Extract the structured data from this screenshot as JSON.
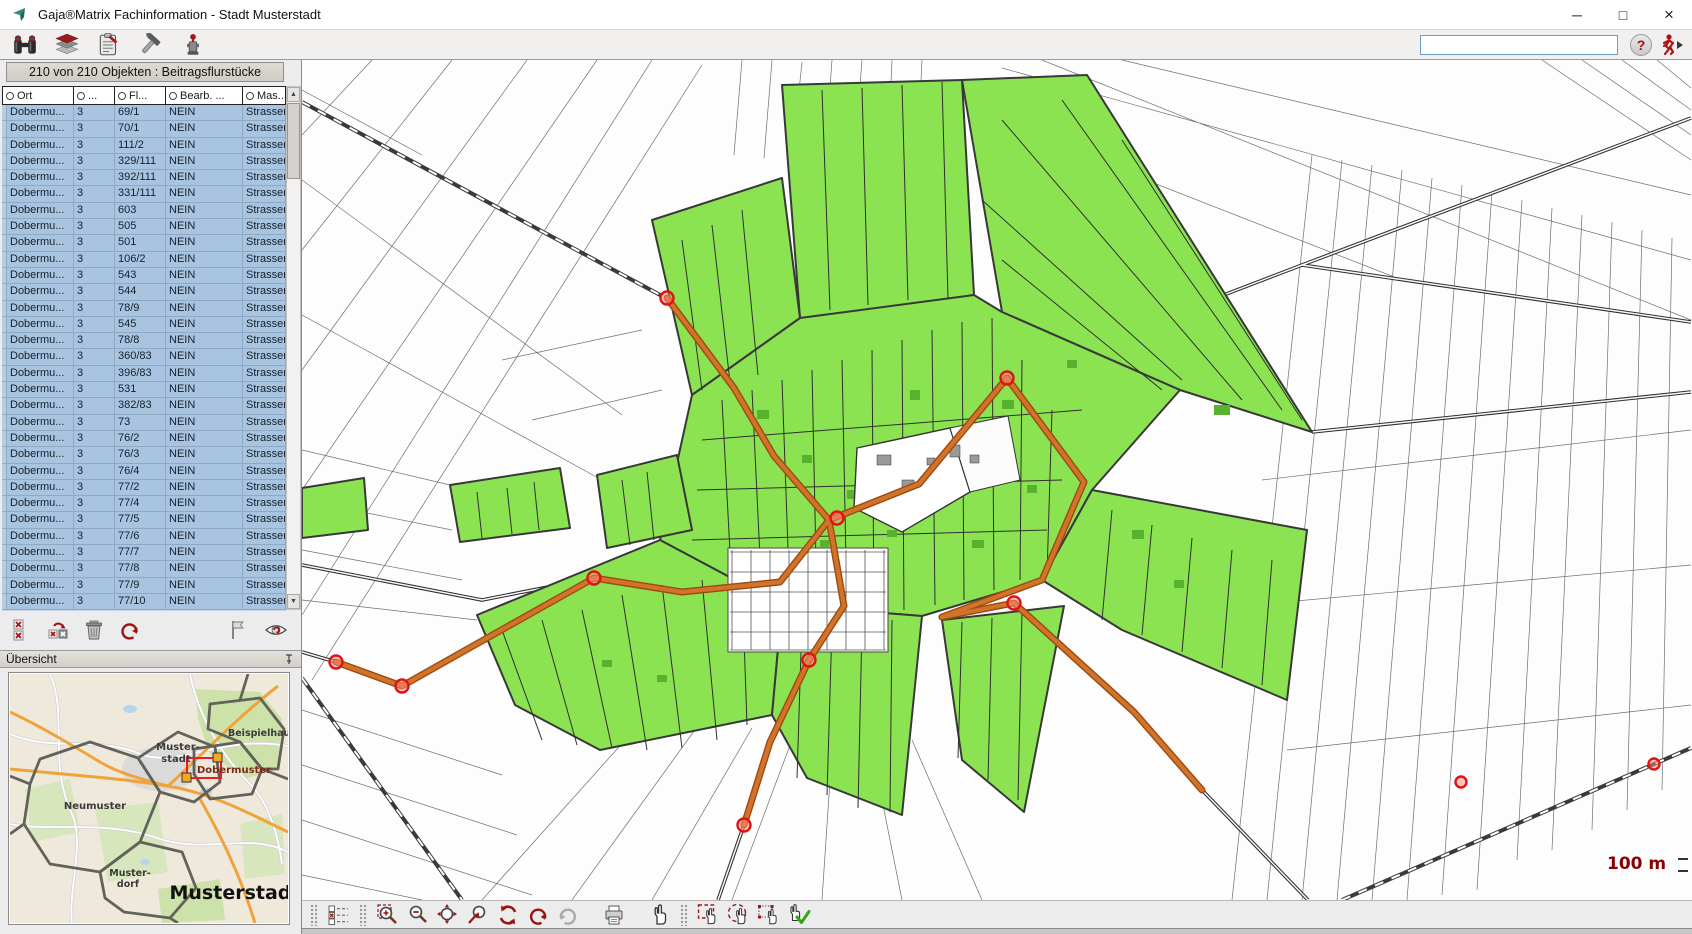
{
  "window": {
    "title": "Gaja®Matrix Fachinformation - Stadt Musterstadt",
    "minimize": "─",
    "maximize": "□",
    "close": "×"
  },
  "toolbar": {
    "icons": [
      "find",
      "layers",
      "report",
      "tools",
      "hydrant"
    ],
    "search_value": "",
    "help_label": "?",
    "exit_icon": "exit-run"
  },
  "results_panel": {
    "header": "210 von 210 Objekten : Beitragsflurstücke",
    "columns": [
      "Ort",
      "...",
      "Fl...",
      "Bearb. ...",
      "Mas..."
    ],
    "rows": [
      {
        "ort": "Dobermu...",
        "nr": "3",
        "fl": "69/1",
        "bearb": "NEIN",
        "mas": "Strassen..."
      },
      {
        "ort": "Dobermu...",
        "nr": "3",
        "fl": "70/1",
        "bearb": "NEIN",
        "mas": "Strassen..."
      },
      {
        "ort": "Dobermu...",
        "nr": "3",
        "fl": "111/2",
        "bearb": "NEIN",
        "mas": "Strassen..."
      },
      {
        "ort": "Dobermu...",
        "nr": "3",
        "fl": "329/111",
        "bearb": "NEIN",
        "mas": "Strassen..."
      },
      {
        "ort": "Dobermu...",
        "nr": "3",
        "fl": "392/111",
        "bearb": "NEIN",
        "mas": "Strassen..."
      },
      {
        "ort": "Dobermu...",
        "nr": "3",
        "fl": "331/111",
        "bearb": "NEIN",
        "mas": "Strassen..."
      },
      {
        "ort": "Dobermu...",
        "nr": "3",
        "fl": "603",
        "bearb": "NEIN",
        "mas": "Strassen..."
      },
      {
        "ort": "Dobermu...",
        "nr": "3",
        "fl": "505",
        "bearb": "NEIN",
        "mas": "Strassen..."
      },
      {
        "ort": "Dobermu...",
        "nr": "3",
        "fl": "501",
        "bearb": "NEIN",
        "mas": "Strassen..."
      },
      {
        "ort": "Dobermu...",
        "nr": "3",
        "fl": "106/2",
        "bearb": "NEIN",
        "mas": "Strassen..."
      },
      {
        "ort": "Dobermu...",
        "nr": "3",
        "fl": "543",
        "bearb": "NEIN",
        "mas": "Strassen..."
      },
      {
        "ort": "Dobermu...",
        "nr": "3",
        "fl": "544",
        "bearb": "NEIN",
        "mas": "Strassen..."
      },
      {
        "ort": "Dobermu...",
        "nr": "3",
        "fl": "78/9",
        "bearb": "NEIN",
        "mas": "Strassen..."
      },
      {
        "ort": "Dobermu...",
        "nr": "3",
        "fl": "545",
        "bearb": "NEIN",
        "mas": "Strassen..."
      },
      {
        "ort": "Dobermu...",
        "nr": "3",
        "fl": "78/8",
        "bearb": "NEIN",
        "mas": "Strassen..."
      },
      {
        "ort": "Dobermu...",
        "nr": "3",
        "fl": "360/83",
        "bearb": "NEIN",
        "mas": "Strassen..."
      },
      {
        "ort": "Dobermu...",
        "nr": "3",
        "fl": "396/83",
        "bearb": "NEIN",
        "mas": "Strassen..."
      },
      {
        "ort": "Dobermu...",
        "nr": "3",
        "fl": "531",
        "bearb": "NEIN",
        "mas": "Strassen..."
      },
      {
        "ort": "Dobermu...",
        "nr": "3",
        "fl": "382/83",
        "bearb": "NEIN",
        "mas": "Strassen..."
      },
      {
        "ort": "Dobermu...",
        "nr": "3",
        "fl": "73",
        "bearb": "NEIN",
        "mas": "Strassen..."
      },
      {
        "ort": "Dobermu...",
        "nr": "3",
        "fl": "76/2",
        "bearb": "NEIN",
        "mas": "Strassen..."
      },
      {
        "ort": "Dobermu...",
        "nr": "3",
        "fl": "76/3",
        "bearb": "NEIN",
        "mas": "Strassen..."
      },
      {
        "ort": "Dobermu...",
        "nr": "3",
        "fl": "76/4",
        "bearb": "NEIN",
        "mas": "Strassen..."
      },
      {
        "ort": "Dobermu...",
        "nr": "3",
        "fl": "77/2",
        "bearb": "NEIN",
        "mas": "Strassen..."
      },
      {
        "ort": "Dobermu...",
        "nr": "3",
        "fl": "77/4",
        "bearb": "NEIN",
        "mas": "Strassen..."
      },
      {
        "ort": "Dobermu...",
        "nr": "3",
        "fl": "77/5",
        "bearb": "NEIN",
        "mas": "Strassen..."
      },
      {
        "ort": "Dobermu...",
        "nr": "3",
        "fl": "77/6",
        "bearb": "NEIN",
        "mas": "Strassen..."
      },
      {
        "ort": "Dobermu...",
        "nr": "3",
        "fl": "77/7",
        "bearb": "NEIN",
        "mas": "Strassen..."
      },
      {
        "ort": "Dobermu...",
        "nr": "3",
        "fl": "77/8",
        "bearb": "NEIN",
        "mas": "Strassen..."
      },
      {
        "ort": "Dobermu...",
        "nr": "3",
        "fl": "77/9",
        "bearb": "NEIN",
        "mas": "Strassen..."
      },
      {
        "ort": "Dobermu...",
        "nr": "3",
        "fl": "77/10",
        "bearb": "NEIN",
        "mas": "Strassen..."
      }
    ],
    "actions": [
      "discard-selection",
      "reload-selection",
      "delete",
      "undo",
      "flag",
      "visibility"
    ]
  },
  "overview_panel": {
    "title": "Übersicht",
    "labels": {
      "beispielhausen": "Beispielhausen",
      "muster1": "Muster-",
      "muster2": "stadt",
      "dobermuster": "Dobermuster",
      "neumuster": "Neumuster",
      "dorf1": "Muster-",
      "dorf2": "dorf",
      "city": "Musterstadt"
    }
  },
  "map": {
    "scale_label": "100 m",
    "tools": [
      "legend",
      "zoom-in",
      "zoom-out",
      "zoom-extent",
      "zoom-previous",
      "refresh",
      "undo",
      "redo",
      "print",
      "pan",
      "select-rect",
      "select-circle",
      "select-polygon",
      "accept-selection"
    ]
  },
  "colors": {
    "selection_green": "#8ce352",
    "road_orange": "#cc6f2c",
    "marker_red": "#e21b1b",
    "row_blue": "#a9c4e1",
    "scale_red": "#8b0000"
  }
}
